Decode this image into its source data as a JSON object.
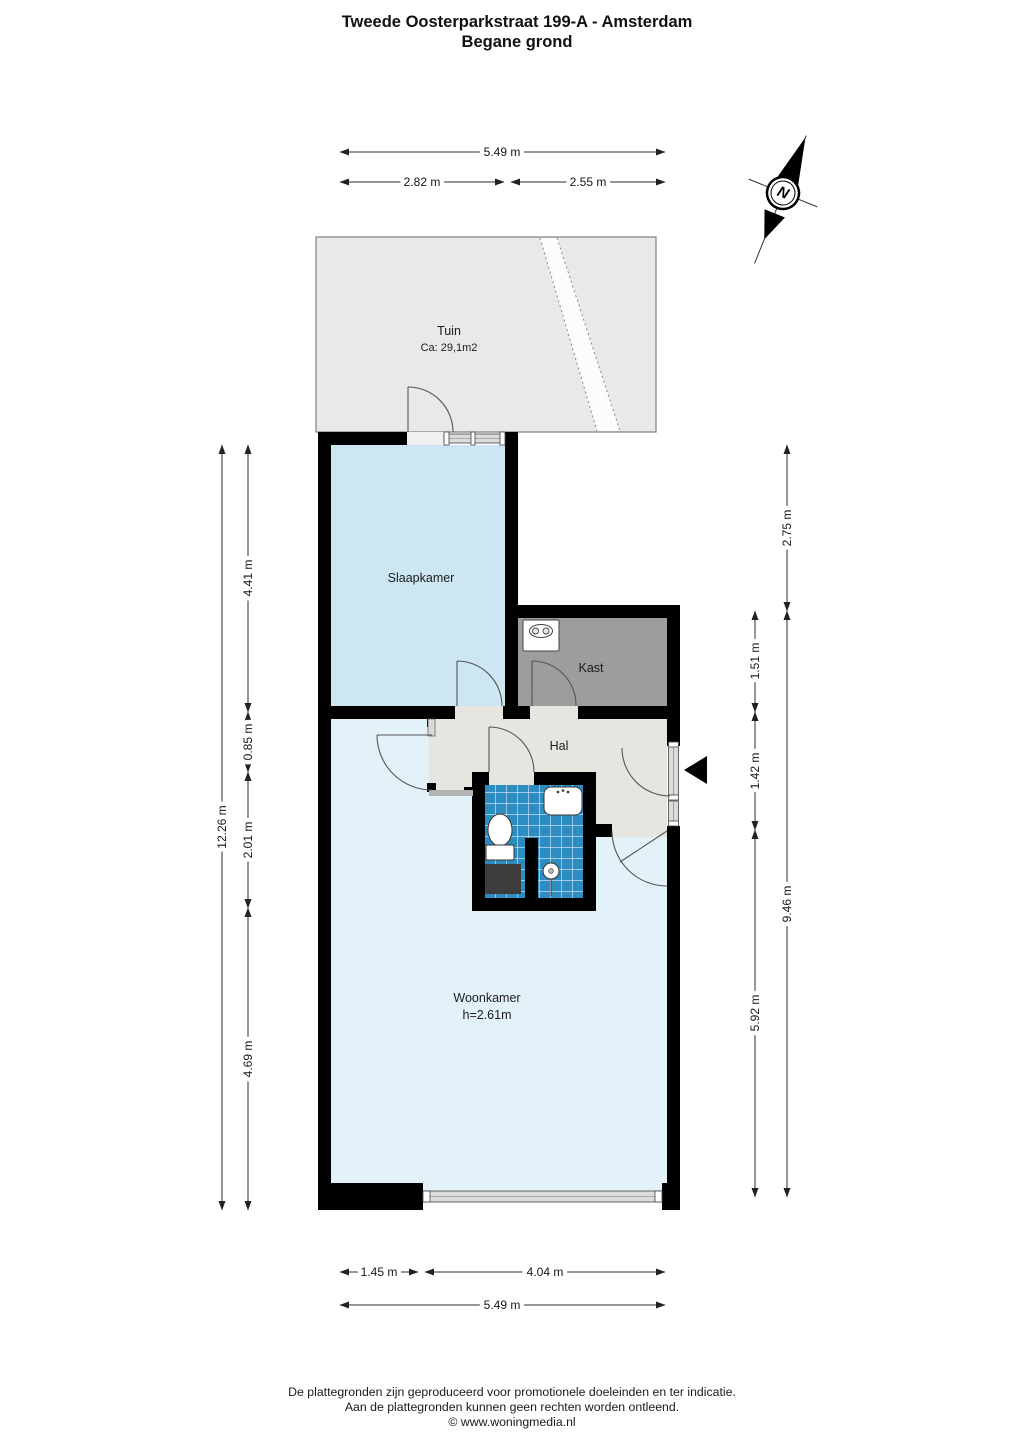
{
  "title": {
    "line1": "Tweede Oosterparkstraat 199-A - Amsterdam",
    "line2": "Begane grond"
  },
  "compass": {
    "label": "N"
  },
  "colors": {
    "wall": "#000000",
    "door_swing": "#555555",
    "dimension_line": "#2c2c2c",
    "tuin_path": "#fcfcfc",
    "cabinet": "#3d3d3d"
  },
  "rooms": {
    "tuin": {
      "name": "Tuin",
      "area": "Ca: 29,1m2",
      "color": "#e9e9e9"
    },
    "slaapkamer": {
      "name": "Slaapkamer",
      "color": "#cde7f2"
    },
    "kast": {
      "name": "Kast",
      "color": "#9d9d9d"
    },
    "hal": {
      "name": "Hal",
      "color": "#e7e5e0"
    },
    "badkamer": {
      "color": "#2e8dc0",
      "grout": "#ddeefb"
    },
    "woonkamer": {
      "name": "Woonkamer",
      "ceiling_height": "h=2.61m",
      "color": "#e3f2f9"
    }
  },
  "dimensions": {
    "top": {
      "total": "5.49 m",
      "left": "2.82 m",
      "right": "2.55 m"
    },
    "left": {
      "total": "12.26 m",
      "segments": [
        "4.41 m",
        "0.85 m",
        "2.01 m",
        "4.69 m"
      ]
    },
    "right": {
      "inner": [
        "1.51 m",
        "1.42 m",
        "5.92 m"
      ],
      "outer": [
        "2.75 m",
        "9.46 m"
      ]
    },
    "bottom": {
      "left": "1.45 m",
      "right": "4.04 m",
      "total": "5.49 m"
    }
  },
  "footer": {
    "line1": "De plattegronden zijn geproduceerd voor promotionele doeleinden en ter indicatie.",
    "line2": "Aan de plattegronden kunnen geen rechten worden ontleend.",
    "line3": "© www.woningmedia.nl"
  }
}
